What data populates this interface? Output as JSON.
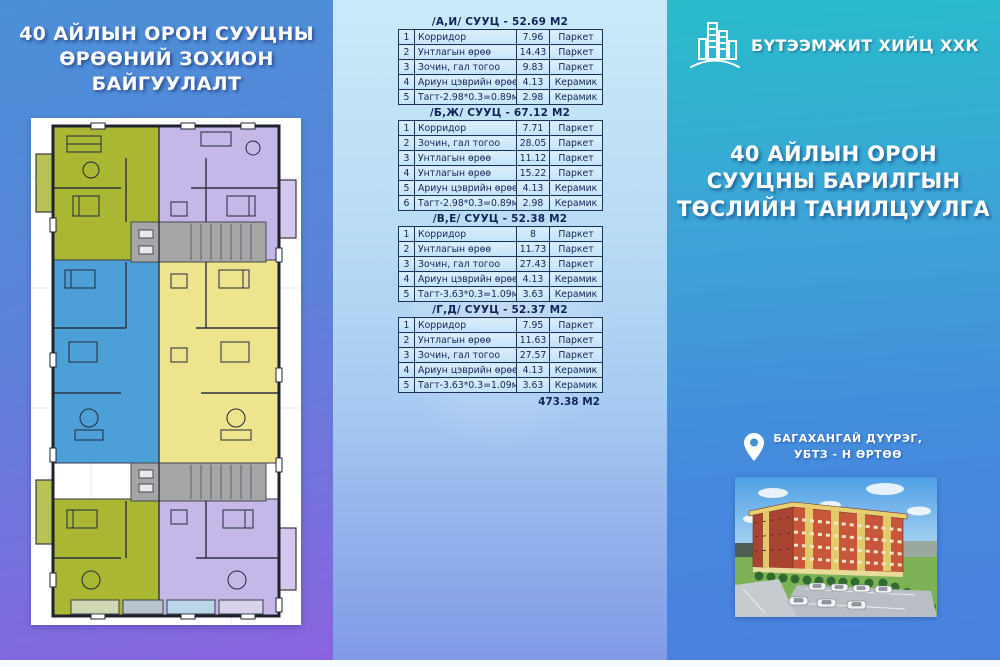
{
  "colors": {
    "left_panel_top": "#4a90d8",
    "left_panel_bottom": "#8a62e0",
    "middle_panel_top": "#c8eaf8",
    "middle_panel_bottom": "#7f99e6",
    "right_panel_top": "#28bccb",
    "right_panel_bottom": "#4b7fe0",
    "table_text": "#14245a",
    "unit_olive": "#a9b733",
    "unit_lavender": "#c6b7e9",
    "unit_blue": "#4d9fd7",
    "unit_yellow": "#eee48d"
  },
  "left_panel": {
    "title_lines": [
      "40 АЙЛЫН ОРОН СУУЦНЫ",
      "ӨРӨӨНИЙ ЗОХИОН",
      "БАЙГУУЛАЛТ"
    ],
    "floor_plan_alt": "floor-plan-drawing"
  },
  "middle_panel": {
    "tables": [
      {
        "title": "/А,И/ СУУЦ - 52.69 М2",
        "rows": [
          [
            "1",
            "Корридор",
            "7.96",
            "Паркет"
          ],
          [
            "2",
            "Унтлагын өрөө",
            "14.43",
            "Паркет"
          ],
          [
            "3",
            "Зочин, гал тогоо",
            "9.83",
            "Паркет"
          ],
          [
            "4",
            "Ариун цэврийн өрөө",
            "4.13",
            "Керамик"
          ],
          [
            "5",
            "Тагт-2.98*0.3=0.89м2",
            "2.98",
            "Керамик"
          ]
        ]
      },
      {
        "title": "/Б,Ж/ СУУЦ - 67.12 М2",
        "rows": [
          [
            "1",
            "Корридор",
            "7.71",
            "Паркет"
          ],
          [
            "2",
            "Зочин, гал тогоо",
            "28.05",
            "Паркет"
          ],
          [
            "3",
            "Унтлагын өрөө",
            "11.12",
            "Паркет"
          ],
          [
            "4",
            "Унтлагын өрөө",
            "15.22",
            "Паркет"
          ],
          [
            "5",
            "Ариун цэврийн өрөө",
            "4.13",
            "Керамик"
          ],
          [
            "6",
            "Тагт-2.98*0.3=0.89м2",
            "2.98",
            "Керамик"
          ]
        ]
      },
      {
        "title": "/В,Е/ СУУЦ - 52.38 М2",
        "rows": [
          [
            "1",
            "Корридор",
            "8",
            "Паркет"
          ],
          [
            "2",
            "Унтлагын өрөө",
            "11.73",
            "Паркет"
          ],
          [
            "3",
            "Зочин, гал тогоо",
            "27.43",
            "Паркет"
          ],
          [
            "4",
            "Ариун цэврийн өрөө",
            "4.13",
            "Керамик"
          ],
          [
            "5",
            "Тагт-3.63*0.3=1.09м2",
            "3.63",
            "Керамик"
          ]
        ]
      },
      {
        "title": "/Г,Д/ СУУЦ - 52.37 М2",
        "rows": [
          [
            "1",
            "Корридор",
            "7.95",
            "Паркет"
          ],
          [
            "2",
            "Унтлагын өрөө",
            "11.63",
            "Паркет"
          ],
          [
            "3",
            "Зочин, гал тогоо",
            "27.57",
            "Паркет"
          ],
          [
            "4",
            "Ариун цэврийн өрөө",
            "4.13",
            "Керамик"
          ],
          [
            "5",
            "Тагт-3.63*0.3=1.09м2",
            "3.63",
            "Керамик"
          ]
        ]
      }
    ],
    "total": "473.38 М2"
  },
  "right_panel": {
    "company": "БҮТЭЭМЖИТ ХИЙЦ ХХК",
    "title_lines": [
      "40  АЙЛЫН ОРОН",
      "СУУЦНЫ БАРИЛГЫН",
      "ТӨСЛИЙН ТАНИЛЦУУЛГА"
    ],
    "location_lines": [
      "БАГАХАНГАЙ ДҮҮРЭГ,",
      "УБТЗ - Н ӨРТӨӨ"
    ]
  }
}
